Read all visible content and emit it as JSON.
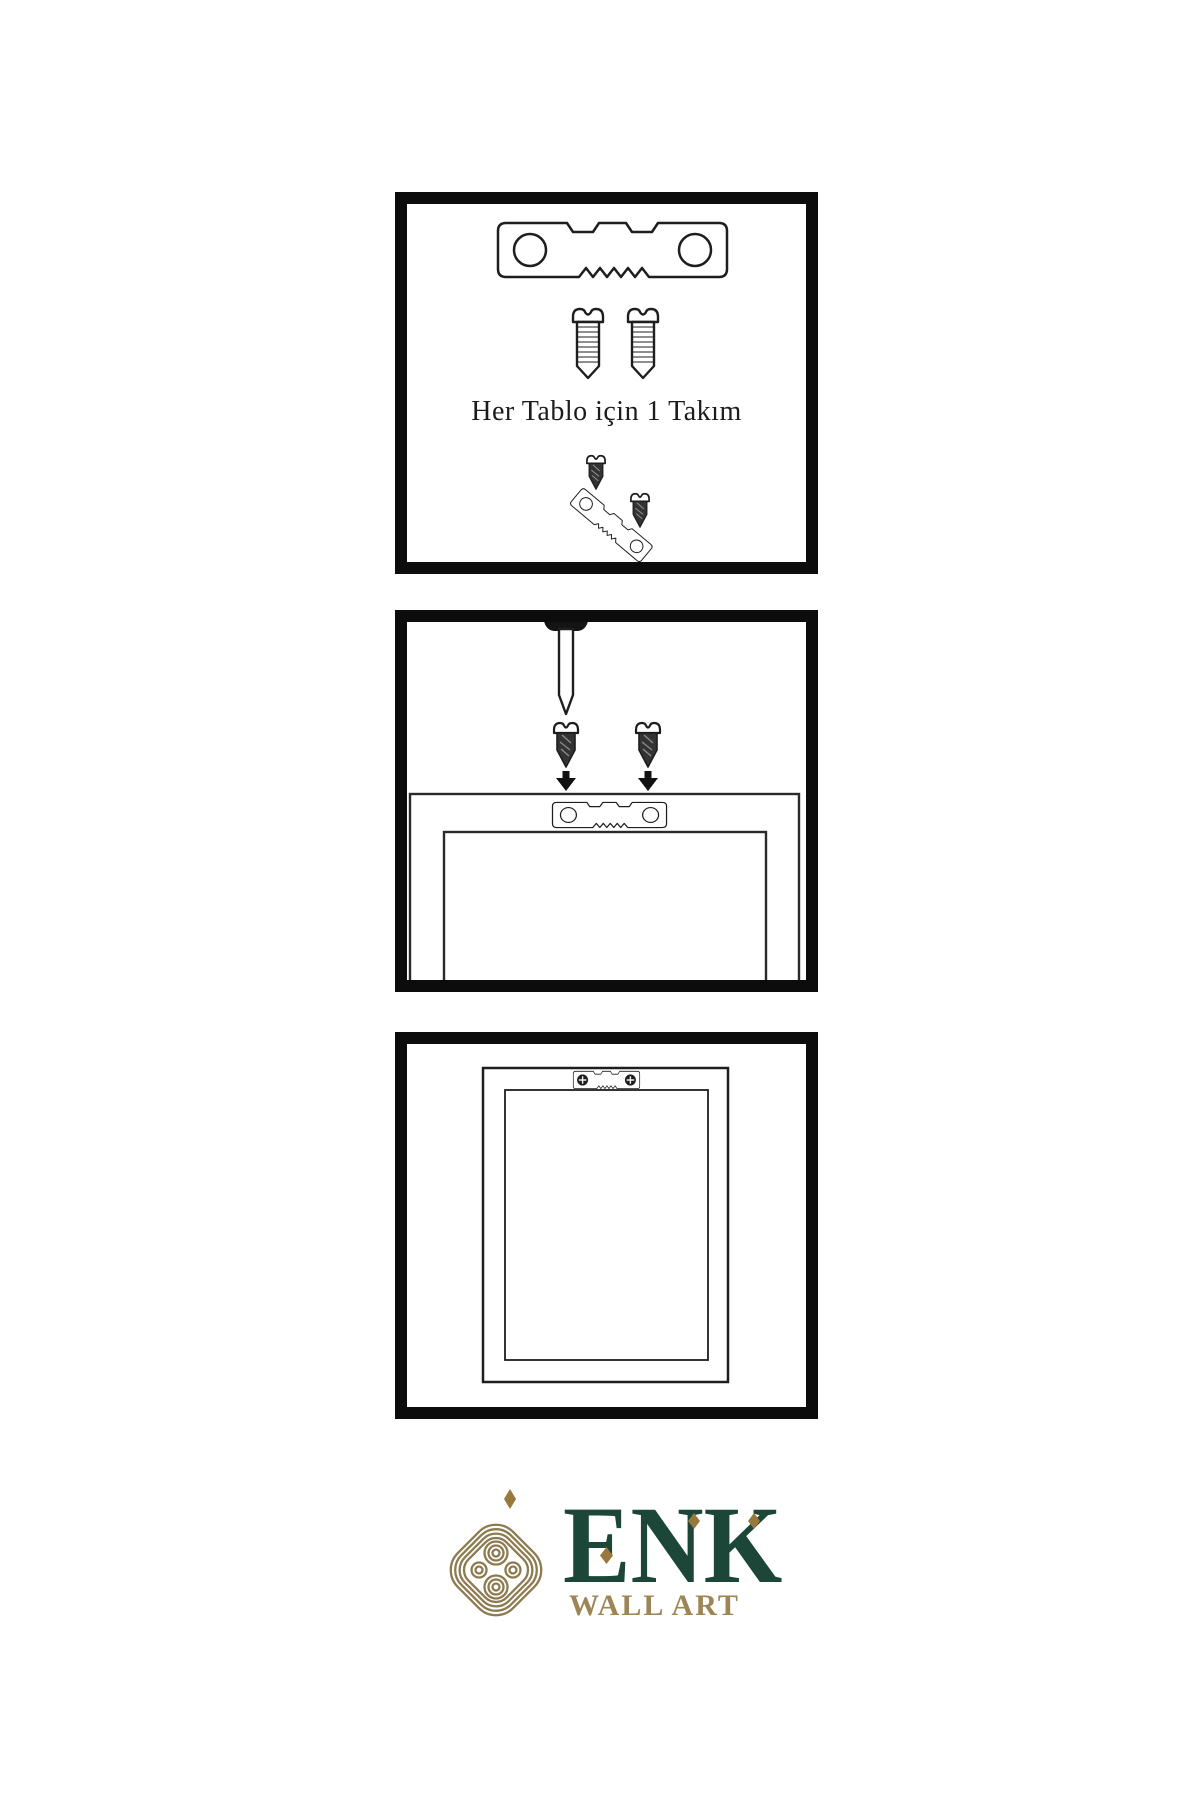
{
  "page": {
    "background": "#ffffff",
    "line_color": "#1e1e1e",
    "panel_border_color": "#0c0c0c"
  },
  "panels": [
    {
      "name": "hardware-kit-panel",
      "caption": "Her Tablo için 1 Takım",
      "icons": [
        "sawtooth-hanger-icon",
        "screw-icon",
        "screw-icon",
        "screw-icon",
        "angled-sawtooth-hanger-icon",
        "screw-icon"
      ]
    },
    {
      "name": "mounting-panel",
      "icons": [
        "nail-icon",
        "screw-icon",
        "down-arrow-icon",
        "screw-icon",
        "down-arrow-icon",
        "sawtooth-hanger-icon",
        "frame-back-icon"
      ]
    },
    {
      "name": "hanging-panel",
      "icons": [
        "framed-artwork-icon",
        "sawtooth-hanger-with-screws-icon"
      ]
    }
  ],
  "logo": {
    "brand": "ENK",
    "tagline": "WALL ART",
    "icon": "interlaced-knot-icon",
    "colors": {
      "brand_green": "#1c4738",
      "gold": "#9d8555",
      "diamond_gold": "#98783c",
      "knot_gold": "#8d7a4f"
    }
  }
}
